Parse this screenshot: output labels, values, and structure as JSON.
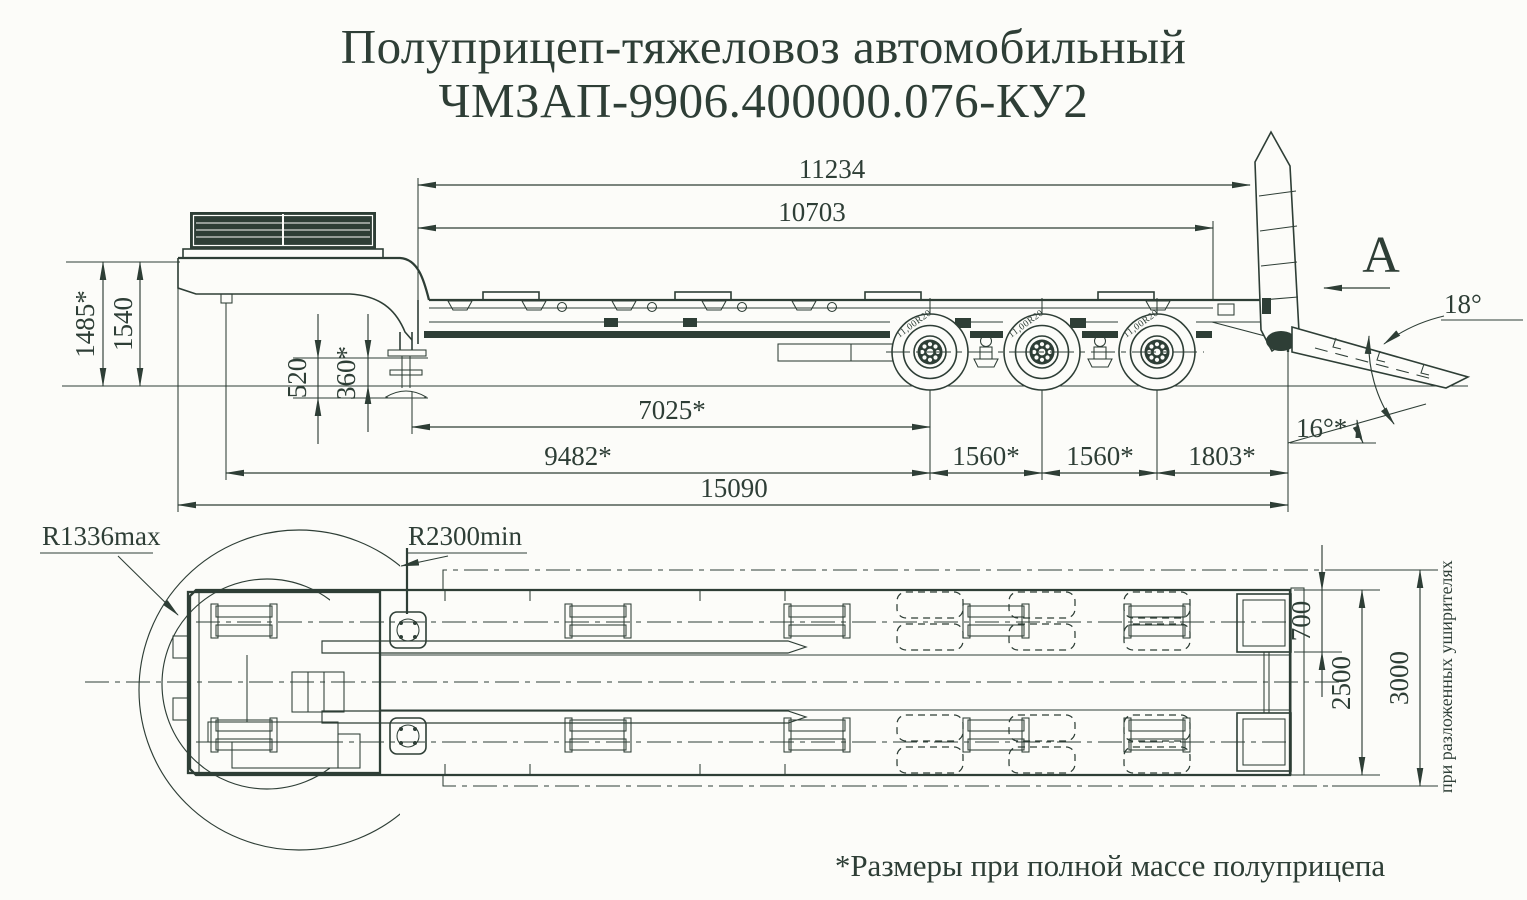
{
  "colors": {
    "ink": "#2e3e36",
    "paper": "#fcfcf9"
  },
  "title": {
    "line1": "Полуприцеп-тяжеловоз автомобильный",
    "line2": "ЧМЗАП-9906.400000.076-КУ2"
  },
  "side_view": {
    "dims": {
      "frame_length": "11234",
      "deck_length": "10703",
      "height_laden": "1485*",
      "height_unladen": "1540",
      "datum_520": "520",
      "datum_360": "360*",
      "leg_to_first_axle": "7025*",
      "kingpin_to_first_axle": "9482*",
      "axle_spacing_12": "1560*",
      "axle_spacing_23": "1560*",
      "rear_overhang": "1803*",
      "overall_length": "15090",
      "ramp_angle": "18°",
      "rear_tilt_angle": "16°*"
    },
    "view_arrow_label": "A",
    "tire_marking": "11,00R20"
  },
  "plan_view": {
    "front_swing_radius_max": "R1336max",
    "rear_swing_radius_min": "R2300min",
    "dims": {
      "ramp_track_offset": "700",
      "deck_width": "2500",
      "extended_width": "3000"
    },
    "extended_width_note": "при разложенных уширителях"
  },
  "footnote": "*Размеры при полной массе полуприцепа"
}
